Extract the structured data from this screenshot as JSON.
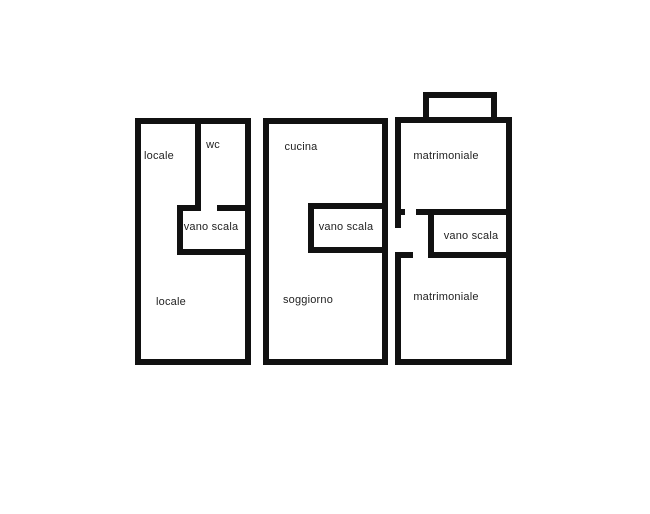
{
  "colors": {
    "background": "#ffffff",
    "walls": "#111111",
    "label_text": "#1f1f1f"
  },
  "units": {
    "left": {
      "rooms": {
        "locale_top": "locale",
        "wc": "wc",
        "vano_scala": "vano scala",
        "locale_bottom": "locale"
      }
    },
    "middle": {
      "rooms": {
        "cucina": "cucina",
        "vano_scala": "vano scala",
        "soggiorno": "soggiorno"
      }
    },
    "right": {
      "rooms": {
        "matrimoniale_top": "matrimoniale",
        "vano_scala": "vano scala",
        "matrimoniale_bottom": "matrimoniale"
      }
    }
  }
}
